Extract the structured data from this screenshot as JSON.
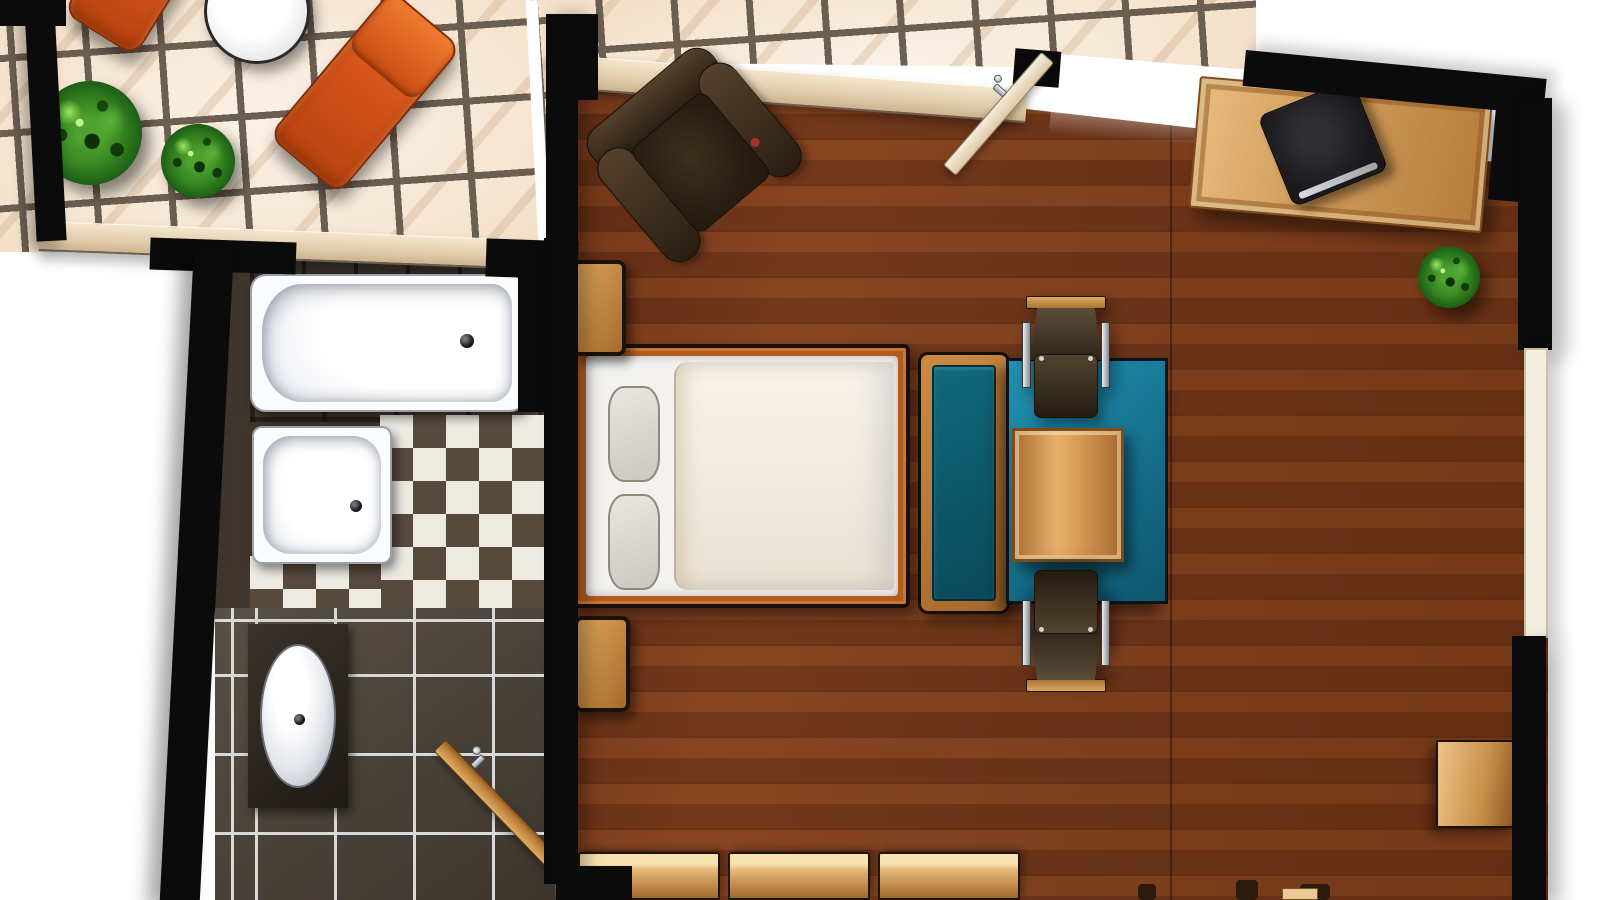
{
  "scene": {
    "type": "apartment-floor-plan-top-view",
    "rooms": [
      {
        "name": "terrace",
        "floor": "beige-ceramic-tiles",
        "furniture": [
          "sun-lounger",
          "sun-lounger-partial",
          "round-side-table",
          "potted-plant-large",
          "potted-plant-small"
        ]
      },
      {
        "name": "bathroom",
        "floor": "dark-tiles-with-checkerboard",
        "furniture": [
          "bathtub",
          "shower-tray",
          "washbasin-on-counter",
          "open-wooden-door"
        ]
      },
      {
        "name": "main-room",
        "floor": "wood-planks",
        "furniture": [
          "leather-armchair",
          "double-bed",
          "pillow-left",
          "pillow-right",
          "nightstand-head",
          "nightstand-foot",
          "teal-bench",
          "teal-area-rug",
          "dining-table",
          "dining-chair-north",
          "dining-chair-south",
          "desk",
          "laptop",
          "potted-plant",
          "wardrobe-units",
          "wall-shelf",
          "open-entry-door"
        ]
      }
    ],
    "palette": {
      "wall": "#0b0b0b",
      "terrace_tile": "#f4e1ca",
      "tile_grout": "#6b5f52",
      "wood_floor": "#7a3d1e",
      "bath_tile_dark": "#4c4339",
      "checker_light": "#edeae2",
      "checker_dark": "#57493c",
      "fixture_white": "#fbfcfe",
      "lounger_orange": "#d4531a",
      "rug_teal": "#15708c",
      "bench_cushion_teal": "#0a4a5c",
      "furniture_wood": "#cf9a58",
      "leather_brown": "#2a1e12",
      "plant_green": "#2e7a1d",
      "sill_beige": "#e2ccab"
    }
  }
}
